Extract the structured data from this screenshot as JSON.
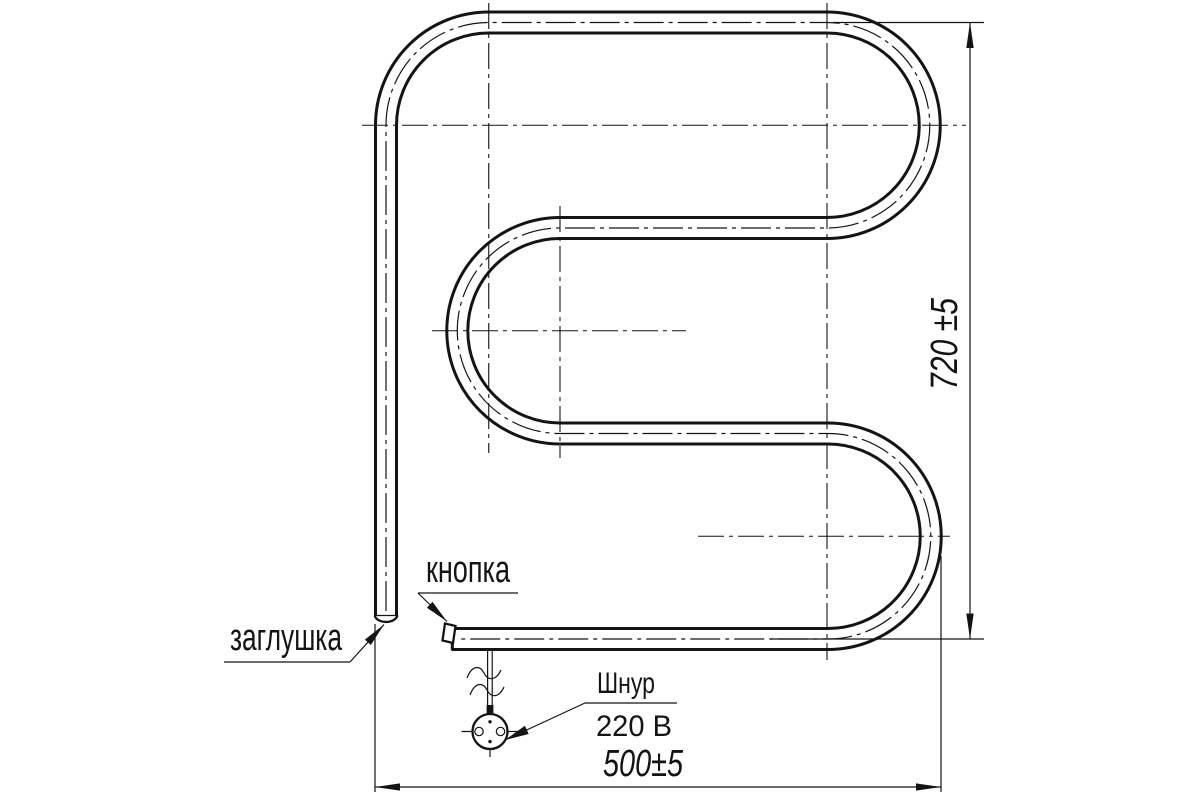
{
  "labels": {
    "cap": "заглушка",
    "button": "кнопка",
    "cord": "Шнур",
    "voltage": "220 В"
  },
  "dimensions": {
    "height": "720 ±5",
    "width": "500±5"
  },
  "colors": {
    "ink": "#141414",
    "background": "#ffffff"
  }
}
